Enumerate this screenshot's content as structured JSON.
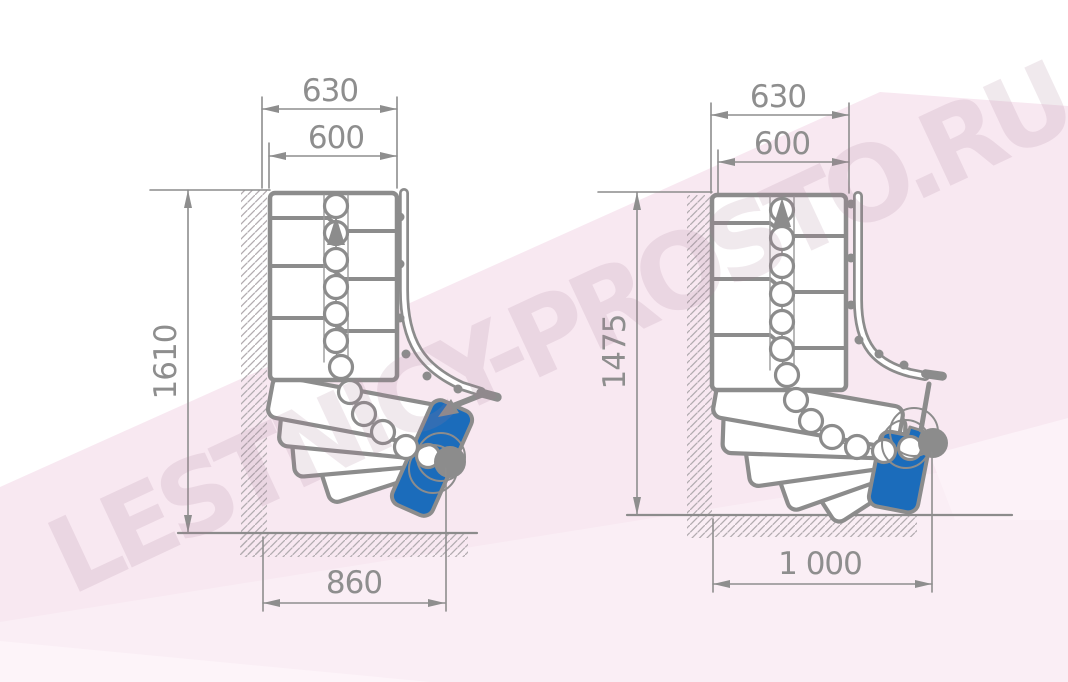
{
  "watermark": {
    "text": "LESTNICY-PROSTO.RU"
  },
  "colors": {
    "line_gray": "#8c8c8c",
    "dim_gray": "#8e8e8e",
    "hatch_gray": "#b2acb0",
    "entry_step_blue": "#1b6cbb",
    "bg_pink": "#f8e8f1",
    "bg_pink_mid": "#faeef5",
    "bg_pink_light": "#fdf4f9"
  },
  "diagrams": [
    {
      "name": "left-staircase-plan",
      "dims": {
        "outer_width": "630",
        "inner_width": "600",
        "total_length": "1610",
        "turn_width": "860"
      }
    },
    {
      "name": "right-staircase-plan",
      "dims": {
        "outer_width": "630",
        "inner_width": "600",
        "total_length": "1475",
        "turn_width": "1 000"
      }
    }
  ]
}
